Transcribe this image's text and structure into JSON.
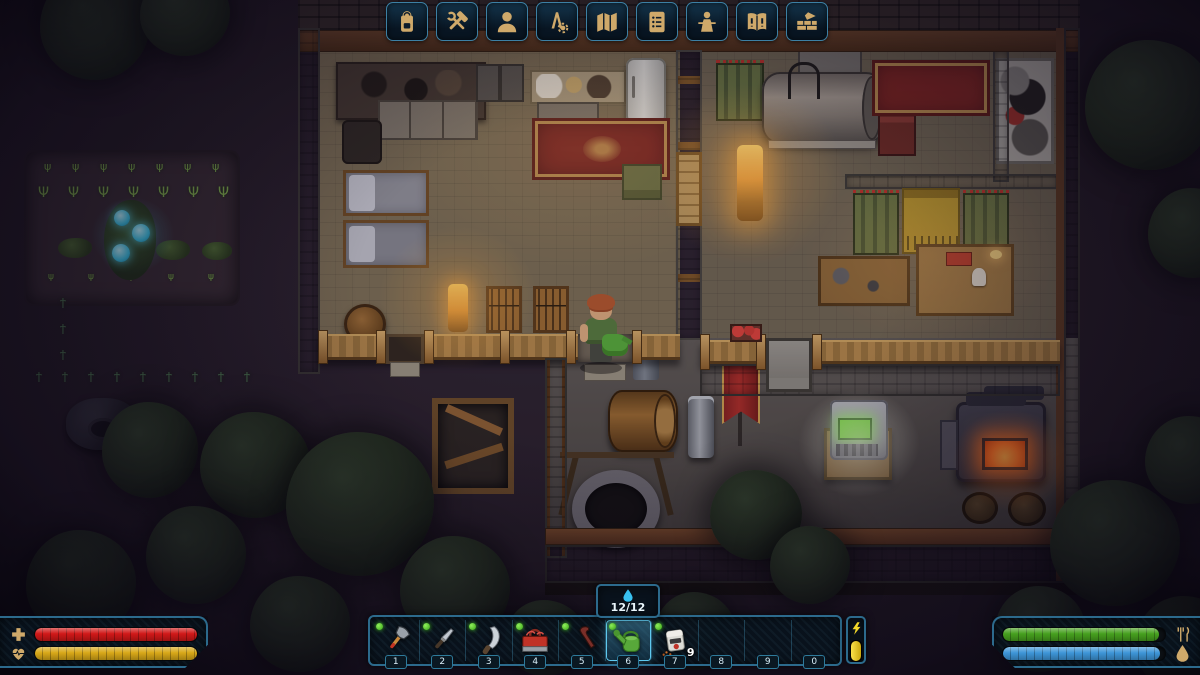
{
  "hud": {
    "toolbar": {
      "buttons": [
        {
          "id": "inventory",
          "icon": "backpack-icon"
        },
        {
          "id": "crafting",
          "icon": "hammer-wrench-icon"
        },
        {
          "id": "character",
          "icon": "character-bust-icon"
        },
        {
          "id": "technologies",
          "icon": "compass-gear-icon"
        },
        {
          "id": "map",
          "icon": "map-icon"
        },
        {
          "id": "quests",
          "icon": "quest-list-icon"
        },
        {
          "id": "social",
          "icon": "podium-speaker-icon"
        },
        {
          "id": "journal",
          "icon": "book-icon"
        },
        {
          "id": "construction",
          "icon": "brick-trowel-icon"
        }
      ]
    },
    "hotbar": {
      "slots": [
        {
          "key": "1",
          "item": "axe",
          "has_item": true
        },
        {
          "key": "2",
          "item": "combat-knife",
          "has_item": true
        },
        {
          "key": "3",
          "item": "machete",
          "has_item": true
        },
        {
          "key": "4",
          "item": "toolbox",
          "has_item": true
        },
        {
          "key": "5",
          "item": "crowbar",
          "has_item": true
        },
        {
          "key": "6",
          "item": "watering-can",
          "has_item": true,
          "selected": true
        },
        {
          "key": "7",
          "item": "dispenser-device",
          "has_item": true,
          "count": "9"
        },
        {
          "key": "8",
          "item": null,
          "has_item": false
        },
        {
          "key": "9",
          "item": null,
          "has_item": false
        },
        {
          "key": "0",
          "item": null,
          "has_item": false
        }
      ],
      "selected_item_tooltip": {
        "icon": "water-drop-icon",
        "value": "12/12"
      },
      "energy": {
        "icon": "lightning-icon",
        "fill": "100%",
        "color": "#e8d020"
      }
    },
    "vitals_left": {
      "health": {
        "icon": "medical-cross-icon",
        "fill": "100%",
        "color": "#d01818"
      },
      "stamina": {
        "icon": "heart-pulse-icon",
        "fill": "100%",
        "color": "#d8a818"
      }
    },
    "vitals_right": {
      "food": {
        "icon": "fork-knife-icon",
        "fill": "96%",
        "color": "#46a01e"
      },
      "water": {
        "icon": "droplet-icon",
        "fill": "97%",
        "color": "#3e96d8"
      }
    },
    "accent_color": "#3aa0c8",
    "icon_gold": "#cfa96a"
  }
}
